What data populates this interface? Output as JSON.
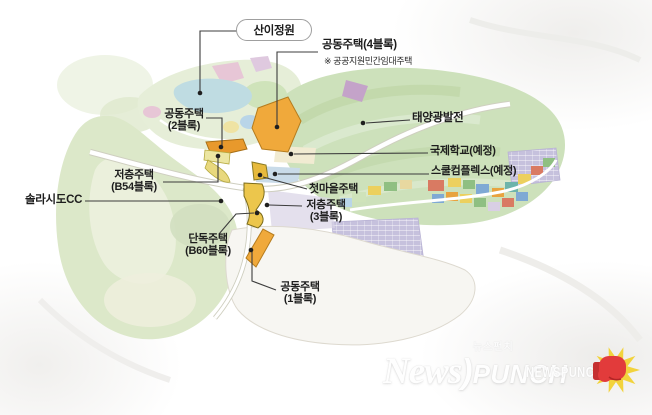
{
  "callouts": {
    "sani_garden": "산이정원",
    "apt4_label": "공동주택(4블록)",
    "apt4_note": "※ 공공지원민간임대주택",
    "apt2_line1": "공동주택",
    "apt2_line2": "(2블록)",
    "b54_line1": "저층주택",
    "b54_line2": "(B54블록)",
    "solaseado_cc": "솔라시도CC",
    "b60_line1": "단독주택",
    "b60_line2": "(B60블록)",
    "first_village": "첫마을주택",
    "apt3_line1": "저층주택",
    "apt3_line2": "(3블록)",
    "apt1_line1": "공동주택",
    "apt1_line2": "(1블록)",
    "solar_power": "태양광발전",
    "intl_school": "국제학교(예정)",
    "school_complex": "스쿨컴플렉스(예정)"
  },
  "watermark": {
    "news": "News",
    "paren": ")",
    "punch": "PUNCH",
    "korean": "뉴스펀치",
    "small_caps": "NEWSPUNCH"
  },
  "colors": {
    "block_orange": "#f0a93b",
    "block_orange_dark": "#e8992c",
    "block_pale_yellow": "#ece6a2",
    "block_gold": "#e7ba3d",
    "golf_green": "#dce8c9",
    "field_green": "#cde1bb",
    "lake_blue": "#bfdce2",
    "panel_lavender": "#c6c1dd",
    "glove_red": "#e23b3b",
    "burst_yellow": "#f2d33c",
    "ink": "#1d1d1d"
  }
}
